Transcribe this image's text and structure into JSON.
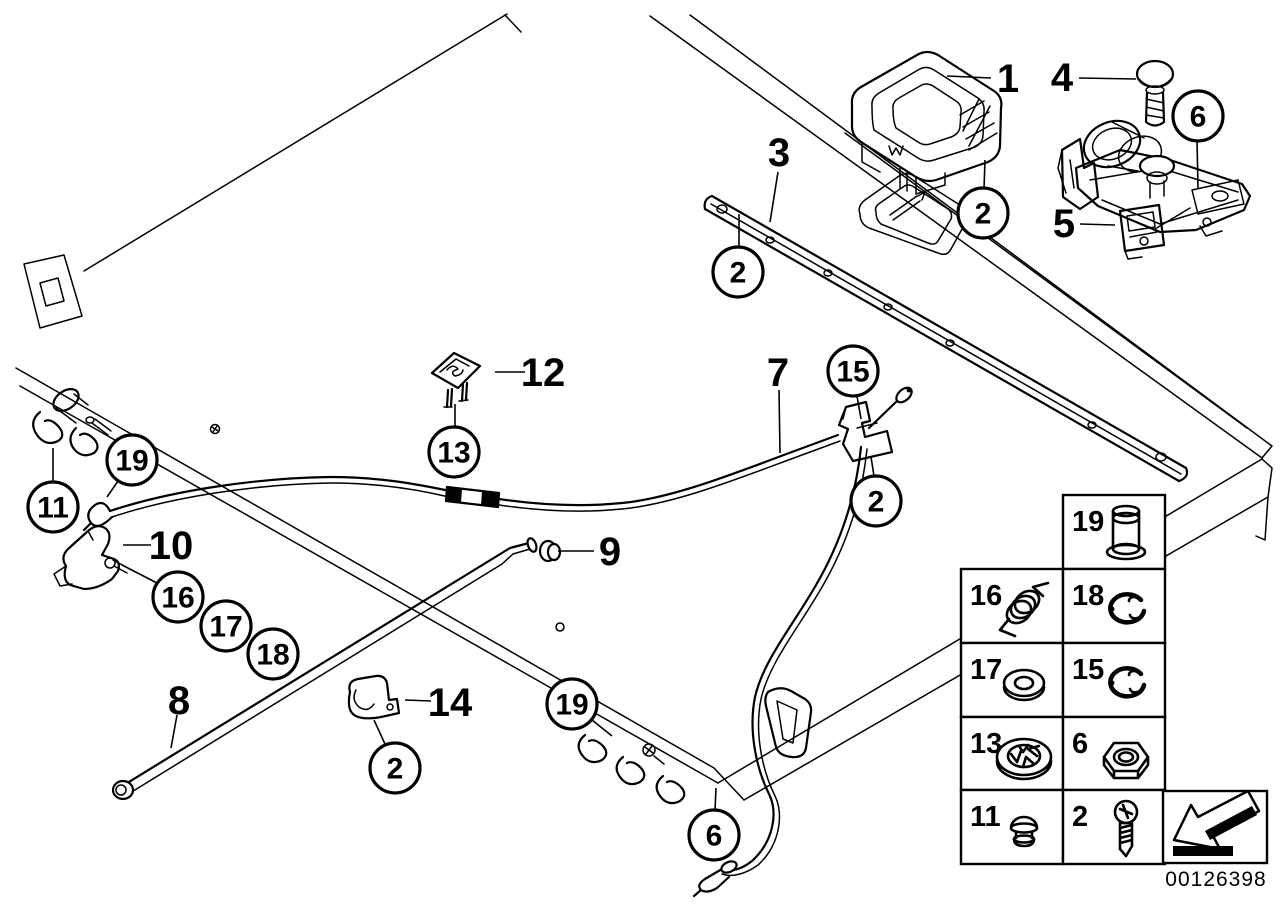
{
  "diagram": {
    "number": "00126398",
    "background": "#ffffff",
    "line_color": "#000000"
  },
  "callouts": {
    "plain": [
      {
        "label": "1",
        "x": 1008,
        "y": 78,
        "leader": [
          947,
          76,
          991,
          78
        ]
      },
      {
        "label": "3",
        "x": 779,
        "y": 152,
        "leader": [
          778,
          172,
          770,
          222
        ]
      },
      {
        "label": "4",
        "x": 1062,
        "y": 77,
        "leader": [
          1079,
          78,
          1136,
          79
        ]
      },
      {
        "label": "5",
        "x": 1064,
        "y": 223,
        "leader": [
          1080,
          224,
          1115,
          225
        ]
      },
      {
        "label": "7",
        "x": 778,
        "y": 372,
        "leader": [
          779,
          390,
          780,
          453
        ]
      },
      {
        "label": "8",
        "x": 179,
        "y": 700,
        "leader": [
          177,
          715,
          171,
          748
        ]
      },
      {
        "label": "9",
        "x": 610,
        "y": 551,
        "leader": [
          558,
          551,
          594,
          551
        ]
      },
      {
        "label": "10",
        "x": 171,
        "y": 545,
        "leader": [
          123,
          545,
          151,
          545
        ]
      },
      {
        "label": "12",
        "x": 543,
        "y": 372,
        "leader": [
          495,
          372,
          525,
          372
        ]
      },
      {
        "label": "14",
        "x": 450,
        "y": 702,
        "leader": [
          405,
          700,
          431,
          701
        ]
      }
    ],
    "circled": [
      {
        "label": "2",
        "x": 738,
        "y": 272,
        "leader": [
          739,
          246,
          739,
          214
        ]
      },
      {
        "label": "2",
        "x": 983,
        "y": 213,
        "leader": [
          984,
          189,
          985,
          160
        ]
      },
      {
        "label": "2",
        "x": 876,
        "y": 501,
        "leader": [
          874,
          476,
          871,
          457
        ]
      },
      {
        "label": "2",
        "x": 395,
        "y": 768,
        "leader": [
          385,
          744,
          374,
          720
        ]
      },
      {
        "label": "6",
        "x": 1198,
        "y": 116,
        "leader": [
          1197,
          140,
          1198,
          188
        ]
      },
      {
        "label": "6",
        "x": 714,
        "y": 835,
        "leader": [
          715,
          811,
          716,
          788
        ]
      },
      {
        "label": "11",
        "x": 53,
        "y": 507,
        "leader": [
          53,
          481,
          53,
          448
        ]
      },
      {
        "label": "13",
        "x": 454,
        "y": 452,
        "leader": [
          455,
          426,
          455,
          404
        ]
      },
      {
        "label": "15",
        "x": 853,
        "y": 371,
        "leader": [
          857,
          396,
          861,
          419
        ]
      },
      {
        "label": "16",
        "x": 178,
        "y": 597,
        "leader": [
          122,
          565,
          157,
          583
        ]
      },
      {
        "label": "17",
        "x": 226,
        "y": 626,
        "leader": null
      },
      {
        "label": "18",
        "x": 273,
        "y": 654,
        "leader": null
      },
      {
        "label": "19",
        "x": 132,
        "y": 460,
        "leader": [
          118,
          481,
          107,
          497
        ]
      },
      {
        "label": "19",
        "x": 572,
        "y": 704,
        "leader": [
          592,
          720,
          612,
          736
        ]
      }
    ]
  },
  "legend": {
    "rows": [
      {
        "cells": [
          {
            "num": "19",
            "icon": "pin",
            "col": 1
          }
        ]
      },
      {
        "cells": [
          {
            "num": "16",
            "icon": "spring",
            "col": 0
          },
          {
            "num": "18",
            "icon": "e-ring",
            "col": 1
          }
        ]
      },
      {
        "cells": [
          {
            "num": "17",
            "icon": "washer",
            "col": 0
          },
          {
            "num": "15",
            "icon": "e-ring",
            "col": 1
          }
        ]
      },
      {
        "cells": [
          {
            "num": "13",
            "icon": "lock-washer",
            "col": 0
          },
          {
            "num": "6",
            "icon": "hex-nut",
            "col": 1
          }
        ]
      },
      {
        "cells": [
          {
            "num": "11",
            "icon": "plug",
            "col": 0
          },
          {
            "num": "2",
            "icon": "screw",
            "col": 1
          }
        ]
      }
    ]
  },
  "direction_arrow": {
    "icon": "direction-arrow"
  }
}
